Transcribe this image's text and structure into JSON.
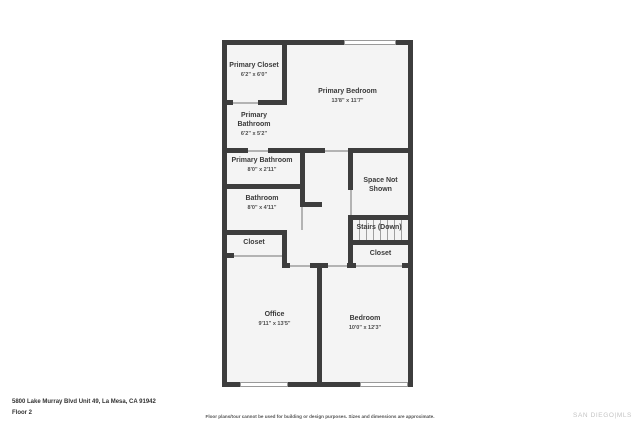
{
  "colors": {
    "wall": "#3d3d3d",
    "floor_fill": "#f4f4f4",
    "label_text": "#3a3a3a",
    "brand_gray": "#c4c4c4"
  },
  "floorplan": {
    "rooms": {
      "primary_closet": {
        "name": "Primary Closet",
        "dims": "6'2\" x 6'0\""
      },
      "primary_bedroom": {
        "name": "Primary Bedroom",
        "dims": "13'8\" x 11'7\""
      },
      "primary_bathroom_upper": {
        "name": "Primary Bathroom",
        "dims": "6'2\" x 5'2\""
      },
      "primary_bathroom_lower": {
        "name": "Primary Bathroom",
        "dims": "8'0\" x 2'11\""
      },
      "bathroom": {
        "name": "Bathroom",
        "dims": "8'0\" x 4'11\""
      },
      "space_not_shown": {
        "name": "Space Not Shown"
      },
      "stairs": {
        "name": "Stairs (Down)"
      },
      "closet_left": {
        "name": "Closet"
      },
      "closet_right": {
        "name": "Closet"
      },
      "office": {
        "name": "Office",
        "dims": "9'11\" x 13'5\""
      },
      "bedroom": {
        "name": "Bedroom",
        "dims": "10'0\" x 12'3\""
      }
    }
  },
  "footer": {
    "address": "5800 Lake Murray Blvd Unit 49, La Mesa, CA 91942",
    "floor_label": "Floor 2",
    "disclaimer": "Floor plans/tour cannot be used for building or design purposes. Sizes and dimensions are approximate.",
    "brand": "SAN DIEGO|MLS"
  }
}
